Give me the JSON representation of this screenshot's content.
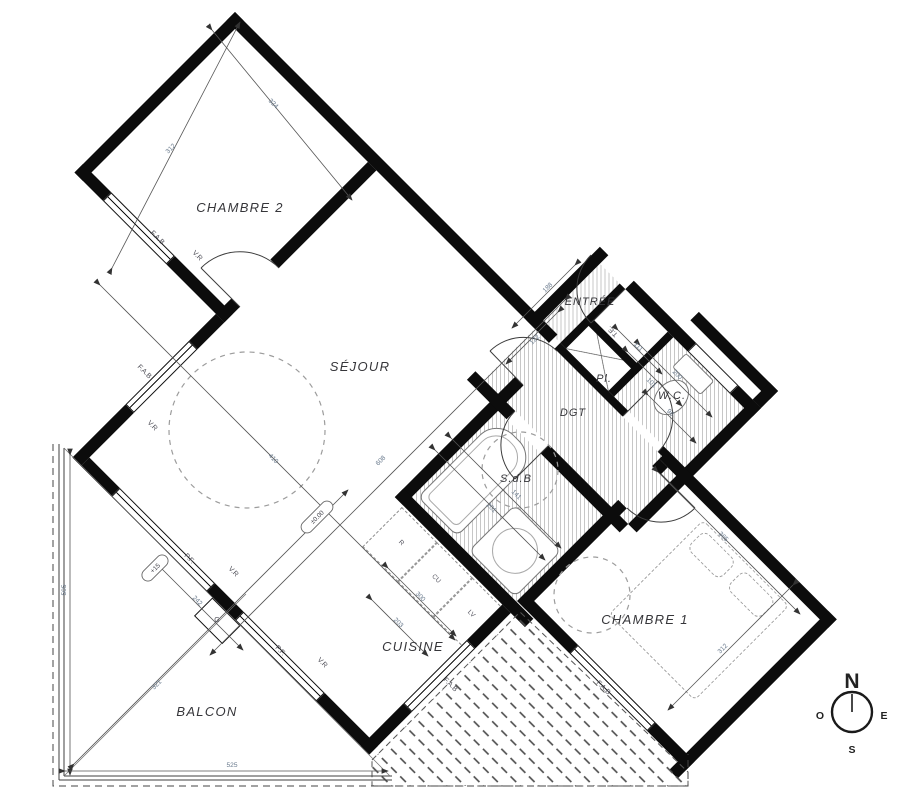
{
  "plan": {
    "rooms": {
      "chambre2": "CHAMBRE 2",
      "sejour": "SÉJOUR",
      "entree": "ENTRÉE",
      "dgt": "DGT",
      "wc": "W.C.",
      "sdb": "S.d.B",
      "chambre1": "CHAMBRE 1",
      "cuisine": "CUISINE",
      "balcon": "BALCON",
      "placard": "Pl.",
      "te": "T.E."
    },
    "windows": {
      "fab": "F.A.B",
      "vr": "V.R",
      "pf": "P.F.",
      "g": "G"
    },
    "kitchen_units": {
      "fridge": "R",
      "cooktop": "CU",
      "dishwasher": "LV"
    },
    "dimensions": {
      "c2_a": "312",
      "c2_b": "324",
      "sejour_a": "608",
      "sejour_b": "410",
      "entree_a": "188",
      "entree_b": "122",
      "sdb_a": "201",
      "sdb_b": "141",
      "wc_a": "200",
      "wc_b": "101",
      "wc_c": "96",
      "dgt_a": "111",
      "c1_a": "365",
      "c1_b": "312",
      "cuisine_a": "300",
      "cuisine_b": "203",
      "balcon_left": "505",
      "balcon_bottom": "525",
      "balcon_diag": "321",
      "balcon_bay": "242"
    },
    "levels": {
      "zero": "±0.00",
      "balcony": "+15"
    },
    "compass": {
      "n": "N",
      "e": "E",
      "s": "S",
      "o": "O"
    }
  }
}
